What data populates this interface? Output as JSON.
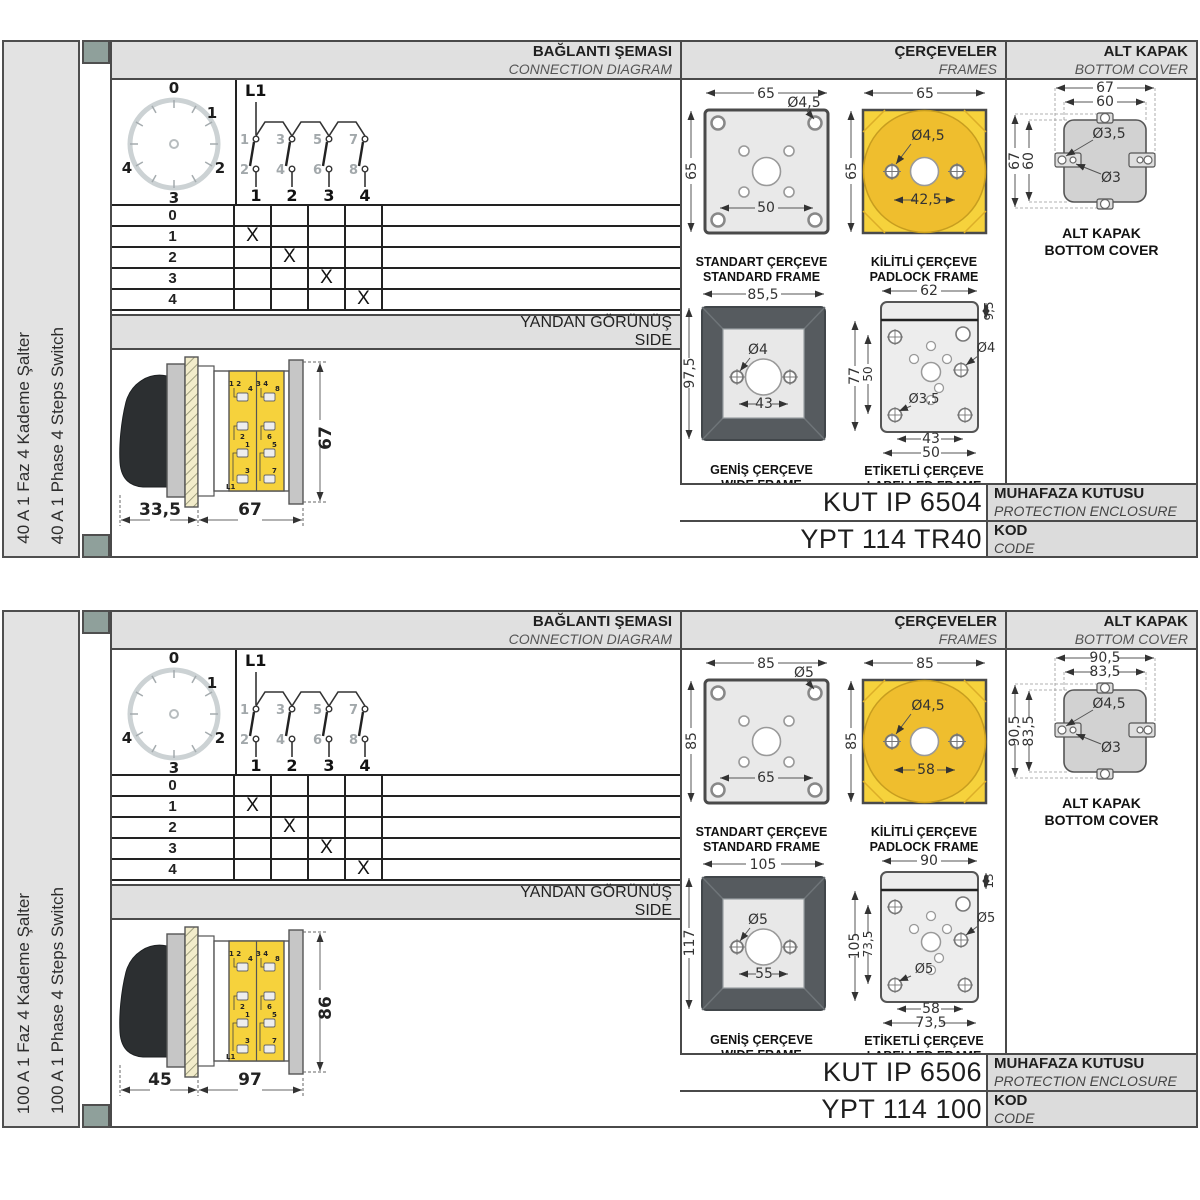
{
  "colors": {
    "accent_yellow": "#f6d23c",
    "accent_yellow_dark": "#efbe2e",
    "frame_dark": "#565b5f",
    "header_gray": "#e0e0e0",
    "corner_square": "#8fa09b"
  },
  "panels": [
    {
      "side_label_tr": "40 A 1 Faz 4 Kademe Şalter",
      "side_label_en": "40 A 1 Phase 4 Steps Switch",
      "headers": {
        "connection_tr": "BAĞLANTI ŞEMASI",
        "connection_en": "CONNECTION DIAGRAM",
        "frames_tr": "ÇERÇEVELER",
        "frames_en": "FRAMES",
        "cover_tr": "ALT KAPAK",
        "cover_en": "BOTTOM COVER",
        "side_tr": "YANDAN GÖRÜNÜŞ",
        "side_en": "SIDE"
      },
      "dial": {
        "pos_0": "0",
        "pos_1": "1",
        "pos_2": "2",
        "pos_3": "3",
        "pos_4": "4"
      },
      "schematic": {
        "phase": "L1",
        "contacts_top": [
          "1",
          "3",
          "5",
          "7"
        ],
        "contacts_bottom": [
          "2",
          "4",
          "6",
          "8"
        ],
        "outputs": [
          "1",
          "2",
          "3",
          "4"
        ]
      },
      "step_table": {
        "rows": [
          {
            "step": "0",
            "marks": [
              "",
              "",
              "",
              ""
            ]
          },
          {
            "step": "1",
            "marks": [
              "X",
              "",
              "",
              ""
            ]
          },
          {
            "step": "2",
            "marks": [
              "",
              "X",
              "",
              ""
            ]
          },
          {
            "step": "3",
            "marks": [
              "",
              "",
              "X",
              ""
            ]
          },
          {
            "step": "4",
            "marks": [
              "",
              "",
              "",
              "X"
            ]
          }
        ]
      },
      "side_view": {
        "dim_handle": "33,5",
        "dim_length": "67",
        "dim_height": "67",
        "terminals": {
          "pair_top_left": "1 2",
          "t4": "4",
          "t2": "2",
          "pair_top_right": "3 4",
          "t8": "8",
          "t6": "6",
          "t1": "1",
          "t3": "3",
          "phase": "L1",
          "t5": "5",
          "t7": "7"
        }
      },
      "frames": {
        "standard": {
          "caption_tr": "STANDART ÇERÇEVE",
          "caption_en": "STANDARD FRAME",
          "dim_width": "65",
          "dim_height": "65",
          "dim_hole": "Ø4,5",
          "dim_pitch": "50"
        },
        "padlock": {
          "caption_tr": "KİLİTLİ ÇERÇEVE",
          "caption_en": "PADLOCK FRAME",
          "dim_width": "65",
          "dim_height": "65",
          "dim_hole": "Ø4,5",
          "dim_pitch": "42,5"
        },
        "wide": {
          "caption_tr": "GENİŞ ÇERÇEVE",
          "caption_en": "WIDE FRAME",
          "dim_width": "85,5",
          "dim_height": "97,5",
          "dim_hole": "Ø4",
          "dim_pitch": "43"
        },
        "labelled": {
          "caption_tr": "ETİKETLİ ÇERÇEVE",
          "caption_en": "LABELLED FRAME",
          "dim_width": "62",
          "dim_strip": "9,5",
          "dim_height": "77",
          "dim_inner_height": "50",
          "dim_hole_side": "Ø4",
          "dim_hole_corner": "Ø3,5",
          "dim_pitch": "43",
          "dim_pitch_outer": "50"
        }
      },
      "bottom_cover": {
        "caption_tr": "ALT KAPAK",
        "caption_en": "BOTTOM COVER",
        "dim_outer_w": "67",
        "dim_inner_w": "60",
        "dim_outer_h": "67",
        "dim_inner_h": "60",
        "dim_hole_big": "Ø3,5",
        "dim_hole_small": "Ø3"
      },
      "codes": {
        "enclosure_value": "KUT IP 6504",
        "enclosure_label_tr": "MUHAFAZA KUTUSU",
        "enclosure_label_en": "PROTECTION ENCLOSURE",
        "code_value": "YPT 114 TR40",
        "code_label_tr": "KOD",
        "code_label_en": "CODE"
      }
    },
    {
      "side_label_tr": "100 A 1 Faz 4 Kademe Şalter",
      "side_label_en": "100 A 1 Phase 4 Steps Switch",
      "headers": {
        "connection_tr": "BAĞLANTI ŞEMASI",
        "connection_en": "CONNECTION DIAGRAM",
        "frames_tr": "ÇERÇEVELER",
        "frames_en": "FRAMES",
        "cover_tr": "ALT KAPAK",
        "cover_en": "BOTTOM COVER",
        "side_tr": "YANDAN GÖRÜNÜŞ",
        "side_en": "SIDE"
      },
      "dial": {
        "pos_0": "0",
        "pos_1": "1",
        "pos_2": "2",
        "pos_3": "3",
        "pos_4": "4"
      },
      "schematic": {
        "phase": "L1",
        "contacts_top": [
          "1",
          "3",
          "5",
          "7"
        ],
        "contacts_bottom": [
          "2",
          "4",
          "6",
          "8"
        ],
        "outputs": [
          "1",
          "2",
          "3",
          "4"
        ]
      },
      "step_table": {
        "rows": [
          {
            "step": "0",
            "marks": [
              "",
              "",
              "",
              ""
            ]
          },
          {
            "step": "1",
            "marks": [
              "X",
              "",
              "",
              ""
            ]
          },
          {
            "step": "2",
            "marks": [
              "",
              "X",
              "",
              ""
            ]
          },
          {
            "step": "3",
            "marks": [
              "",
              "",
              "X",
              ""
            ]
          },
          {
            "step": "4",
            "marks": [
              "",
              "",
              "",
              "X"
            ]
          }
        ]
      },
      "side_view": {
        "dim_handle": "45",
        "dim_length": "97",
        "dim_height": "86",
        "terminals": {
          "pair_top_left": "1 2",
          "t4": "4",
          "t2": "2",
          "pair_top_right": "3 4",
          "t8": "8",
          "t6": "6",
          "t1": "1",
          "t3": "3",
          "phase": "L1",
          "t5": "5",
          "t7": "7"
        }
      },
      "frames": {
        "standard": {
          "caption_tr": "STANDART ÇERÇEVE",
          "caption_en": "STANDARD FRAME",
          "dim_width": "85",
          "dim_height": "85",
          "dim_hole": "Ø5",
          "dim_pitch": "65"
        },
        "padlock": {
          "caption_tr": "KİLİTLİ ÇERÇEVE",
          "caption_en": "PADLOCK FRAME",
          "dim_width": "85",
          "dim_height": "85",
          "dim_hole": "Ø4,5",
          "dim_pitch": "58"
        },
        "wide": {
          "caption_tr": "GENİŞ ÇERÇEVE",
          "caption_en": "WIDE FRAME",
          "dim_width": "105",
          "dim_height": "117",
          "dim_hole": "Ø5",
          "dim_pitch": "55"
        },
        "labelled": {
          "caption_tr": "ETİKETLİ ÇERÇEVE",
          "caption_en": "LABELLED FRAME",
          "dim_width": "90",
          "dim_strip": "13",
          "dim_height": "105",
          "dim_inner_height": "73,5",
          "dim_hole_side": "Ø5",
          "dim_hole_corner": "Ø5",
          "dim_pitch": "58",
          "dim_pitch_outer": "73,5"
        }
      },
      "bottom_cover": {
        "caption_tr": "ALT KAPAK",
        "caption_en": "BOTTOM COVER",
        "dim_outer_w": "90,5",
        "dim_inner_w": "83,5",
        "dim_outer_h": "90,5",
        "dim_inner_h": "83,5",
        "dim_hole_big": "Ø4,5",
        "dim_hole_small": "Ø3"
      },
      "codes": {
        "enclosure_value": "KUT IP 6506",
        "enclosure_label_tr": "MUHAFAZA KUTUSU",
        "enclosure_label_en": "PROTECTION ENCLOSURE",
        "code_value": "YPT 114 100",
        "code_label_tr": "KOD",
        "code_label_en": "CODE"
      }
    }
  ]
}
